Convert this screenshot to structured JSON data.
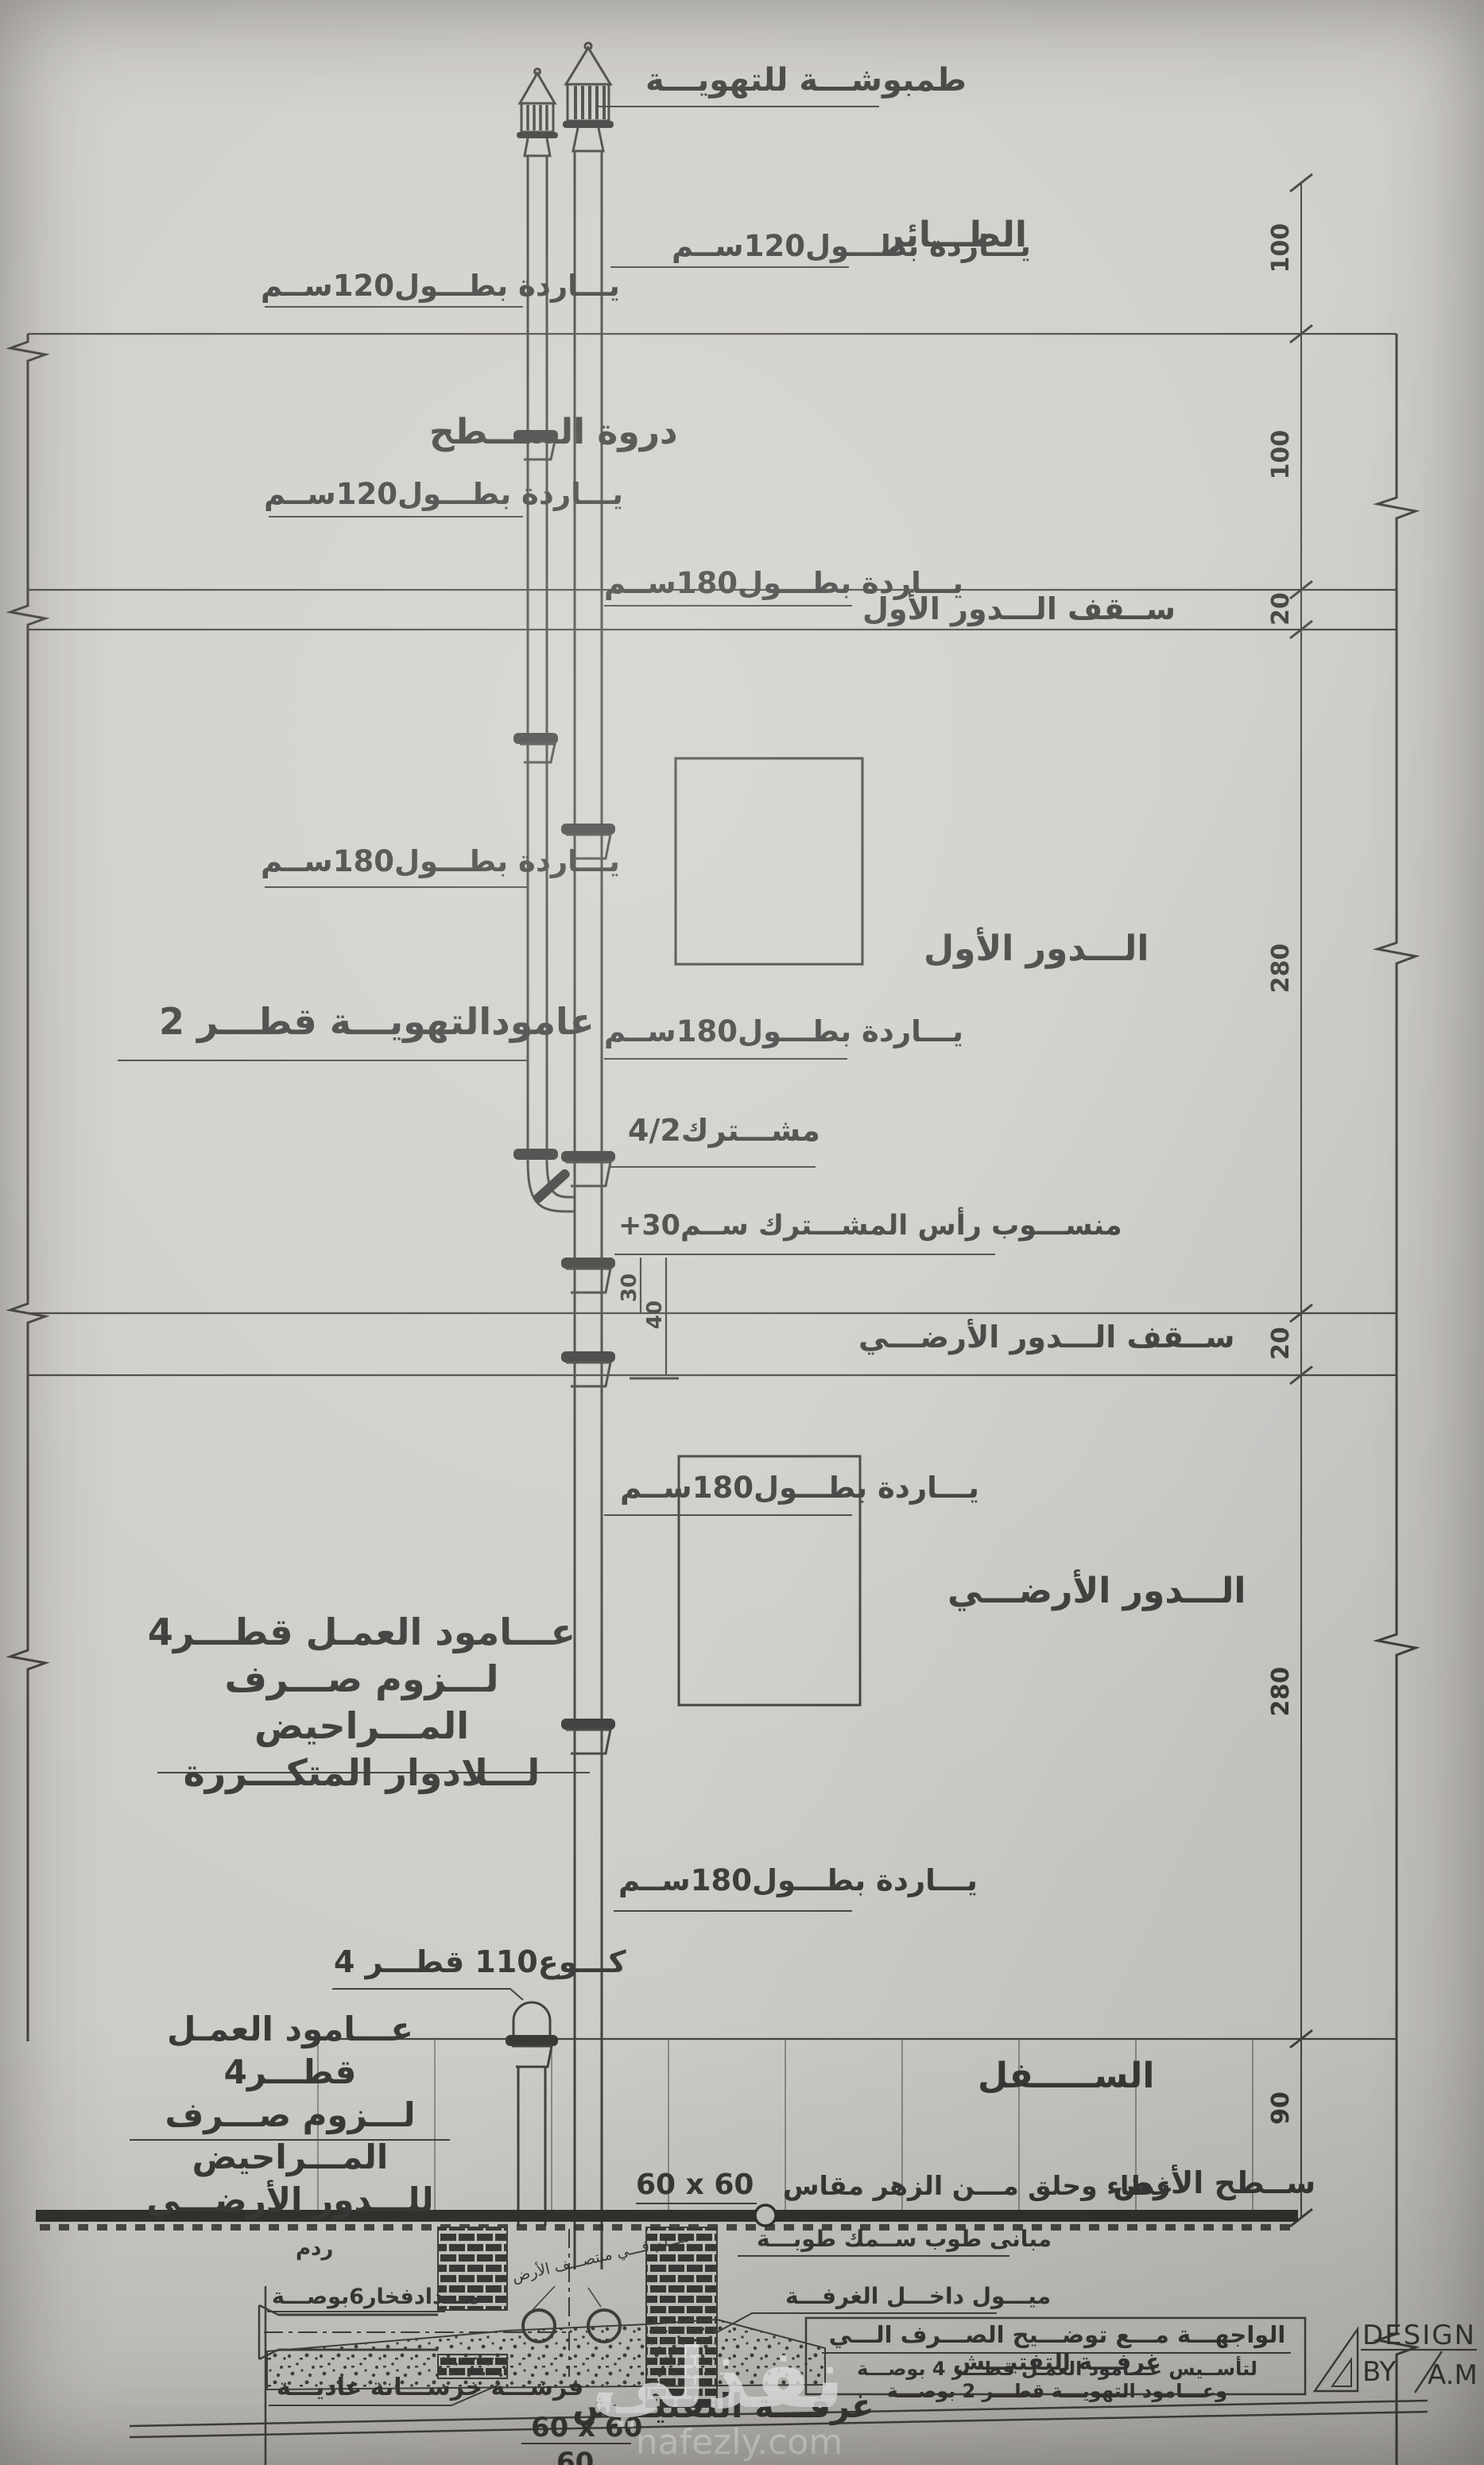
{
  "sheet": {
    "labels": {
      "vent_cap": "طمبوشـــة للتهويـــة",
      "taer": "الطـــائر",
      "parapet": "دروة الســـطح",
      "first_floor_slab": "ســقف الـــدور الأول",
      "first_floor": "الـــدور الأول",
      "ground_floor_slab": "ســقف الـــدور الأرضـــي",
      "ground_floor": "الـــدور الأرضـــي",
      "lower_level": "الســـــفل",
      "yarda120": "يـــاردة بطـــول120ســم",
      "yarda180": "يـــاردة بطـــول180ســم",
      "vent_stack": "عامودالتهويـــة قطـــر 2",
      "mushtarak": "مشـــترك4/2",
      "mushtarak_level": "منســـوب رأس المشـــترك ســم30+",
      "soil_typical_1": "عـــامود العمـل قطـــر4",
      "soil_typical_2": "لـــزوم صـــرف المـــراحيض",
      "soil_typical_3": "لـــلادوار المتكـــررة",
      "soil_ground_1": "عـــامود العمـل قطـــر4",
      "soil_ground_2": "لـــزوم صـــرف المـــراحيض",
      "soil_ground_3": "للـــدور الأرضـــي",
      "elbow": "كـــوع110 قطـــر 4",
      "ground_surface": "ســطح الأرض",
      "cover_note": "غطاء وحلق مـــن الزهر مقاس",
      "cover_size": "60 x 60",
      "backfill": "ردم",
      "clay_pipe": "مـــدادفخار6بوصـــة",
      "brick_wall": "مبانى طوب ســمك طوبـــة",
      "slope_note": "ميـــول داخـــل الغرفـــة",
      "chamber_note": "ســلم فـــي منتصـــف الأرض",
      "concrete_bed": "فرشـــة خرســـانة عاديـــة",
      "chamber_title": "غرفـــة التفتيـــش",
      "chamber_size": "60 x 60",
      "chamber_depth": "60"
    },
    "dimensions": {
      "parapet_upper": "100",
      "parapet_lower": "100",
      "slab1": "20",
      "floor1": "280",
      "slab0": "20",
      "floor0": "280",
      "plinth": "90",
      "offset30": "30",
      "offset40": "40"
    },
    "title_block": {
      "line1": "الواجهـــة مـــع توضـــيح الصـــرف الـــي غرفـــة التفتيـــش",
      "line2": "لتأســيس عـــامود العمـل قطـــر 4 بوصـــة وعـــامود التهويـــة قطـــر 2 بوصـــة",
      "design": "DESIGN",
      "by": "BY",
      "initials": "A.M"
    },
    "watermark": {
      "brand": "نفذلي",
      "domain": "nafezly.com"
    }
  }
}
